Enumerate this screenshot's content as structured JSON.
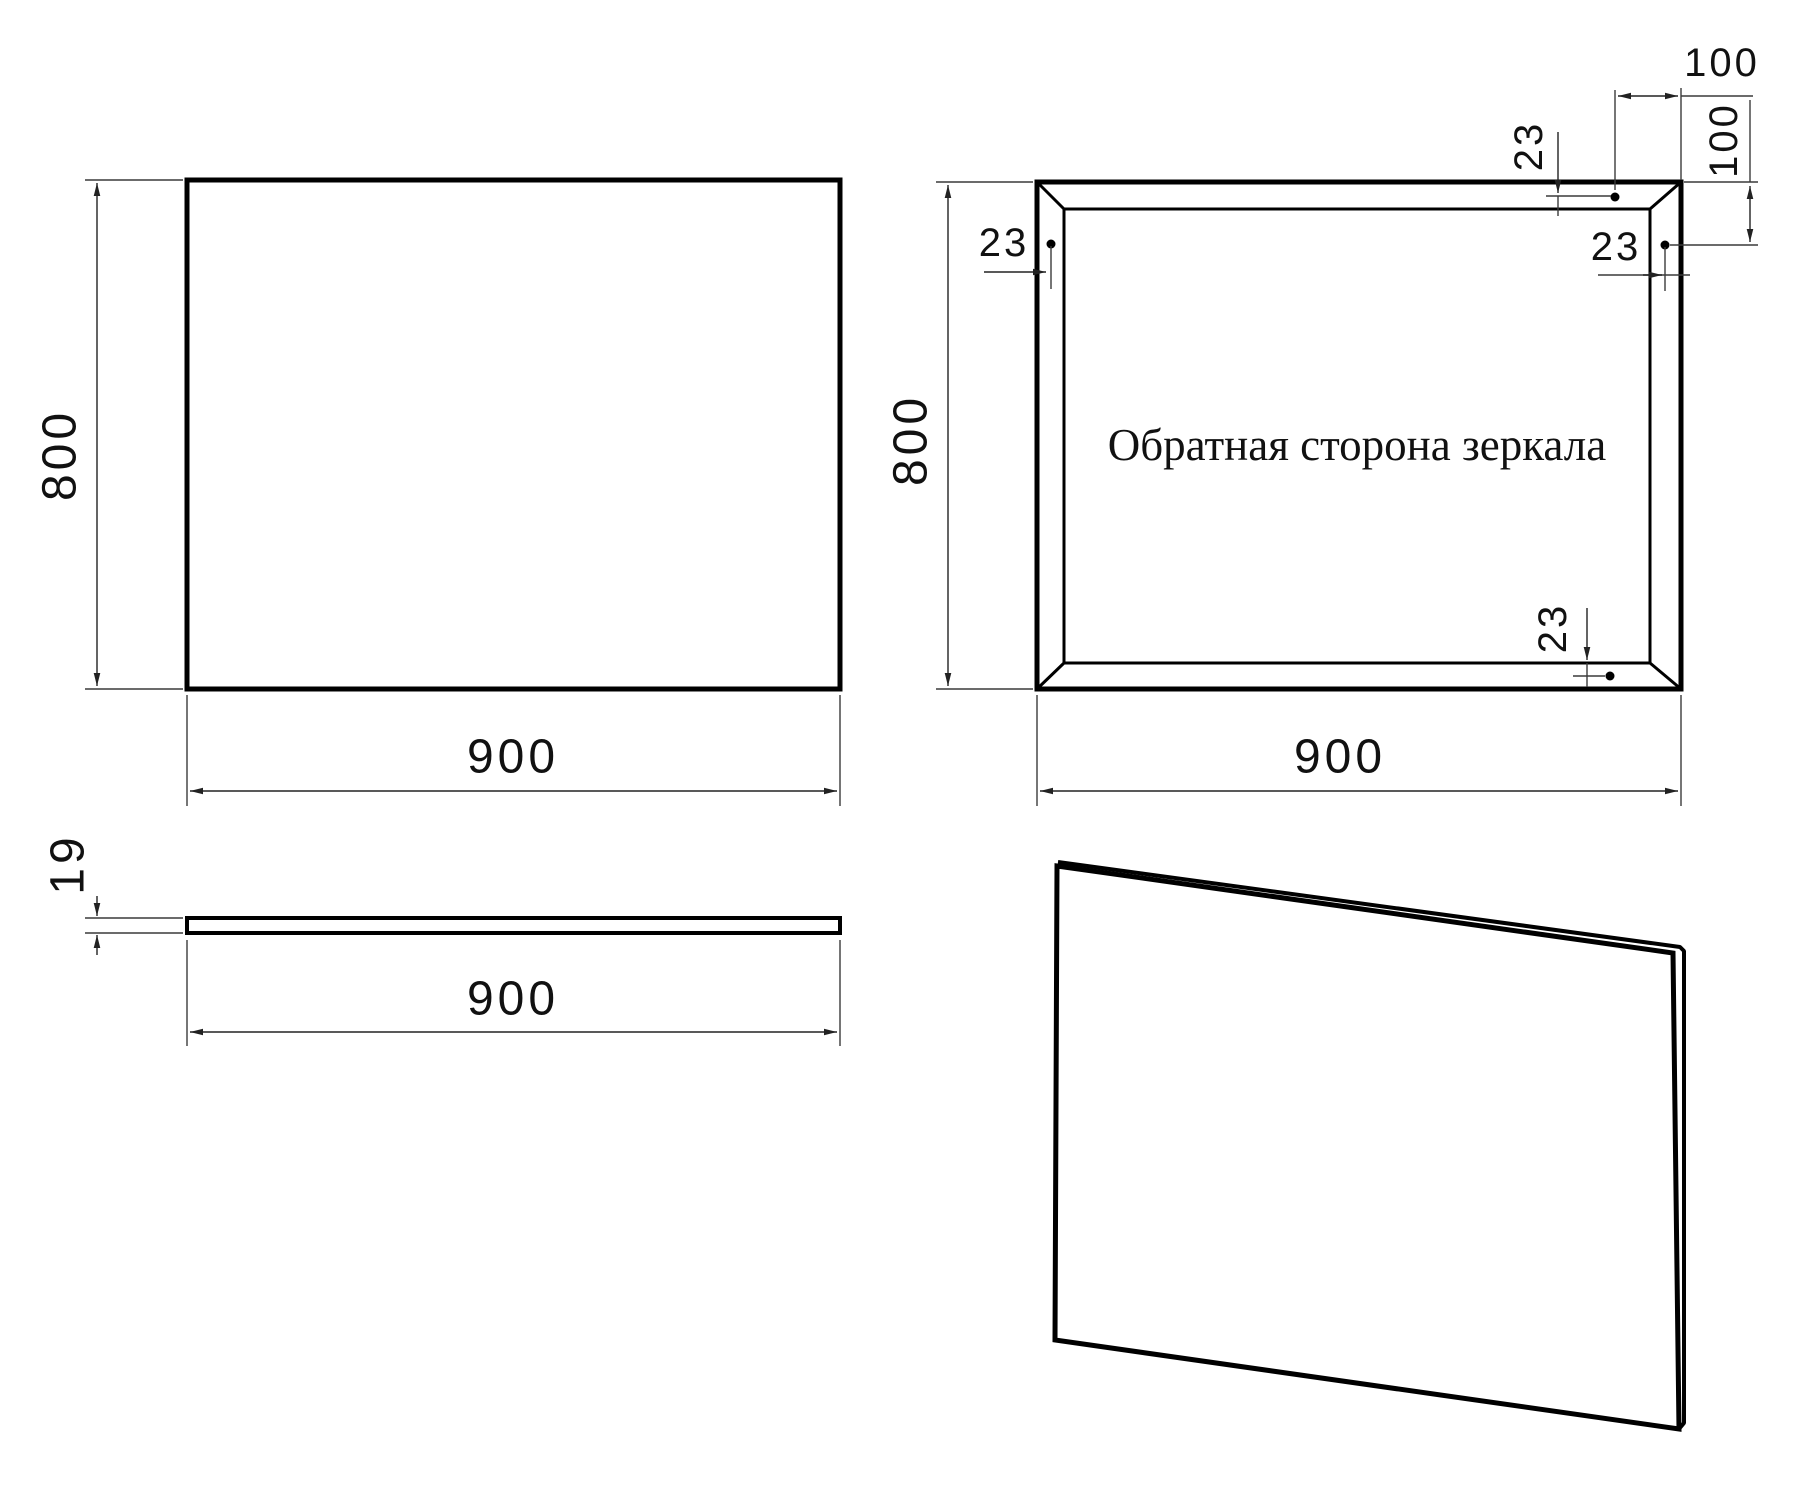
{
  "document": {
    "background": "#ffffff",
    "line_color": "#000000"
  },
  "views": {
    "front": {
      "height": "800",
      "width": "900"
    },
    "back": {
      "height": "800",
      "width": "900",
      "title": "Обратная сторона зеркала",
      "offset_top": "23",
      "offset_left": "23",
      "offset_right": "23",
      "offset_bottom": "23",
      "spacing_top": "100",
      "spacing_right": "100"
    },
    "side": {
      "thickness": "19",
      "width": "900"
    }
  }
}
